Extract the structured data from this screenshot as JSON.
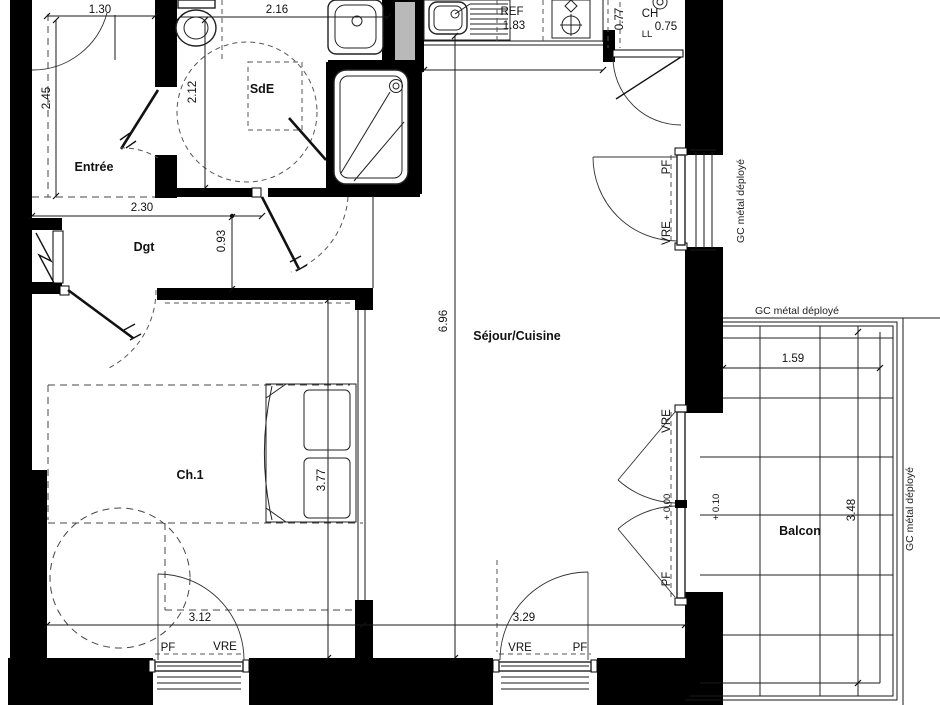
{
  "rooms": {
    "entree": "Entrée",
    "sde": "SdE",
    "dgt": "Dgt",
    "ch1": "Ch.1",
    "sejour_cuisine": "Séjour/Cuisine",
    "balcon": "Balcon"
  },
  "appliances": {
    "fridge": "REF",
    "water_heater": "CH",
    "washer": "LL"
  },
  "openings": {
    "pf": "PF",
    "vre": "VRE"
  },
  "levels": {
    "interior": "+ 0.00",
    "balcony": "+ 0.10"
  },
  "railing": {
    "label": "GC métal déployé"
  },
  "dims": {
    "entree_w": "1.30",
    "sde_w": "2.16",
    "entree_h": "2.45",
    "sde_h": "2.12",
    "dgt_w": "2.30",
    "dgt_h": "0.93",
    "kitchen_w": "1.83",
    "ch_niche_w": "0.77",
    "ch_niche_d": "0.75",
    "sejour_h": "6.96",
    "ch1_h": "3.77",
    "ch1_w": "3.12",
    "sejour_w": "3.29",
    "balcon_w": "1.59",
    "balcon_h": "3.48"
  },
  "colors": {
    "wall": "#000000",
    "shaft": "#b9b9b9"
  }
}
